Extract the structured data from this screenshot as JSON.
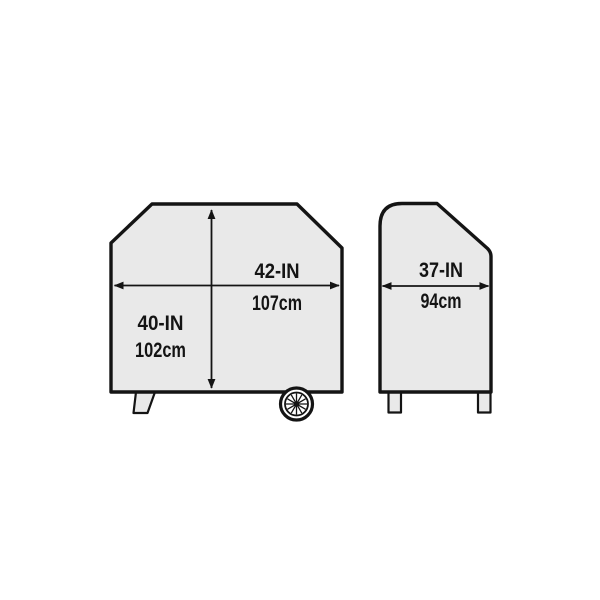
{
  "diagram": {
    "background_color": "#ffffff",
    "shape_fill_color": "#e9e9e9",
    "line_color": "#141414",
    "icons": {
      "wheel": "spoked-wheel-icon"
    },
    "front_view": {
      "width_label_in": "42-IN",
      "width_label_cm": "107cm",
      "height_label_in": "40-IN",
      "height_label_cm": "102cm"
    },
    "side_view": {
      "depth_label_in": "37-IN",
      "depth_label_cm": "94cm"
    }
  }
}
